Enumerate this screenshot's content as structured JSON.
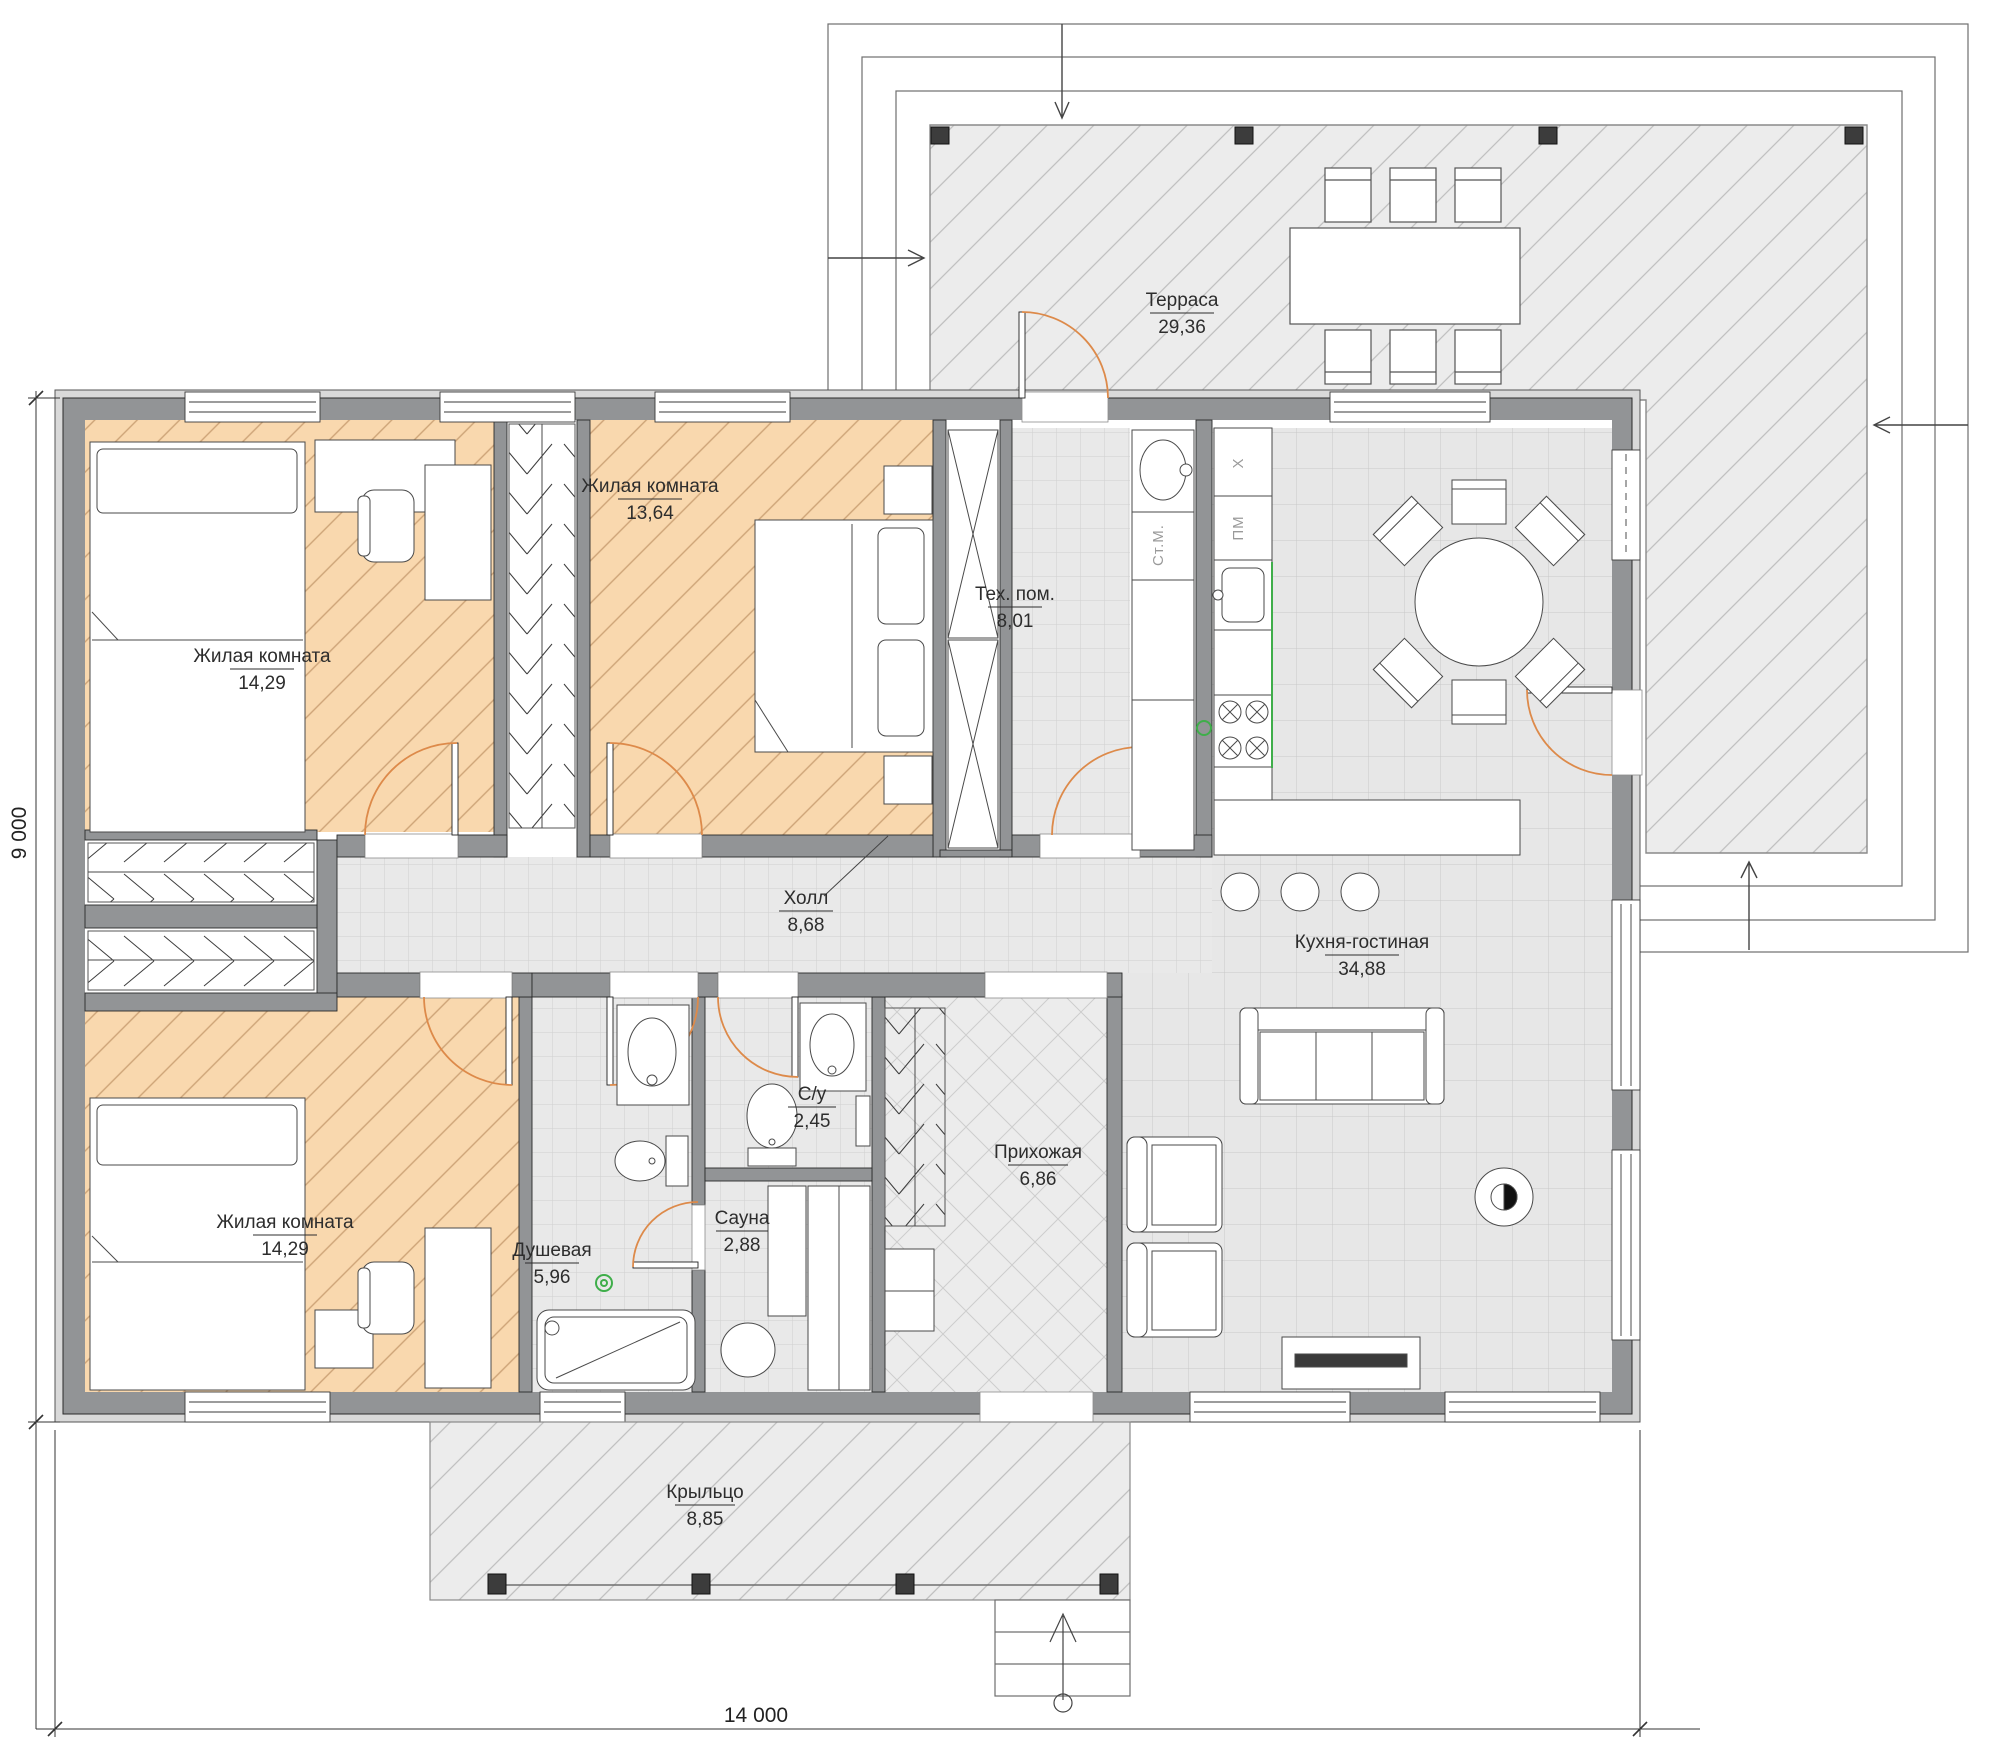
{
  "drawing": {
    "type": "floor-plan",
    "dimensions": {
      "width": "14 000",
      "height": "9 000"
    },
    "rooms": {
      "terrace": {
        "name": "Терраса",
        "area": "29,36"
      },
      "bedroom_top_left": {
        "name": "Жилая комната",
        "area": "14,29"
      },
      "bedroom_top_mid": {
        "name": "Жилая комната",
        "area": "13,64"
      },
      "tech": {
        "name": "Тех. пом.",
        "area": "8,01"
      },
      "hall": {
        "name": "Холл",
        "area": "8,68"
      },
      "kitchen_living": {
        "name": "Кухня-гостиная",
        "area": "34,88"
      },
      "bedroom_bottom_left": {
        "name": "Жилая комната",
        "area": "14,29"
      },
      "shower": {
        "name": "Душевая",
        "area": "5,96"
      },
      "wc": {
        "name": "С/у",
        "area": "2,45"
      },
      "sauna": {
        "name": "Сауна",
        "area": "2,88"
      },
      "entry": {
        "name": "Прихожая",
        "area": "6,86"
      },
      "porch": {
        "name": "Крыльцо",
        "area": "8,85"
      }
    },
    "appliances": {
      "washing_machine": "Ст.М.",
      "dishwasher": "ПМ",
      "fridge": "Х"
    },
    "colors": {
      "room_fill_accent": "#f9d8ae",
      "wall": "#929496",
      "door_arc": "#dd8a4a",
      "equipment_green": "#3fae4a",
      "tile": "#e9e9e9"
    }
  }
}
